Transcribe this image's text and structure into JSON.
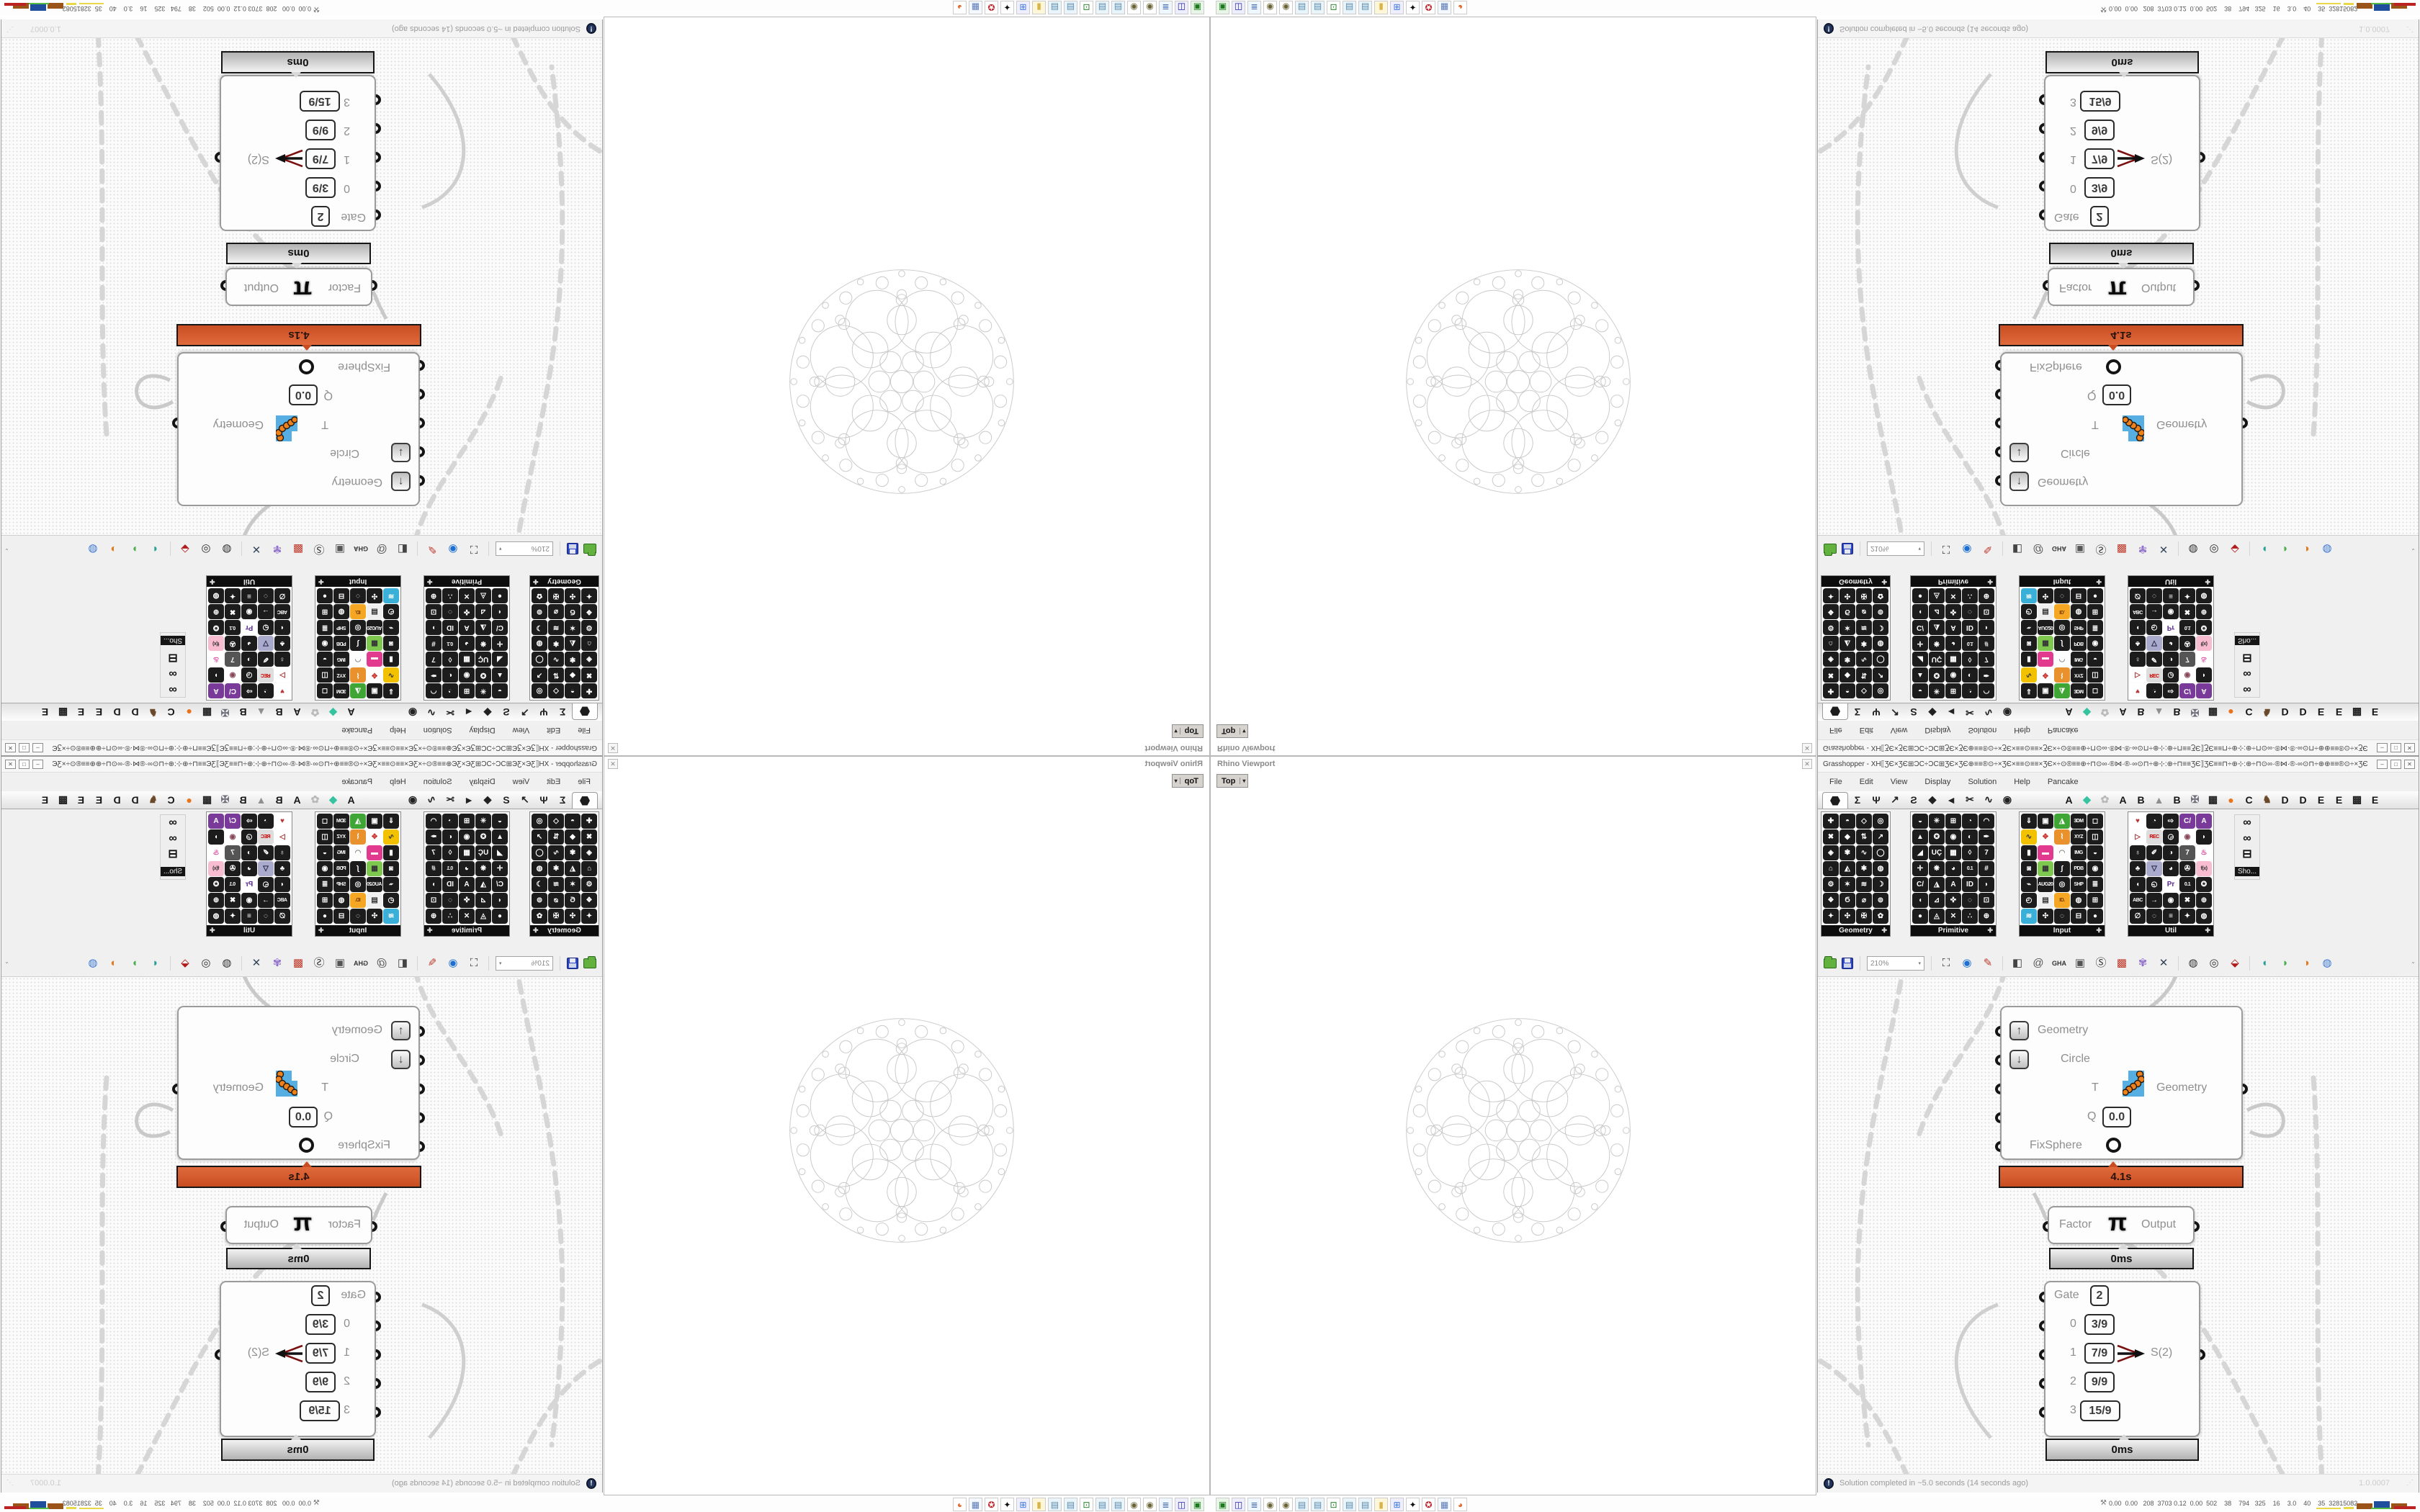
{
  "window": {
    "title": "Grasshopper - XH⟦ƷЄ×ƷЄ⊞ƆϹ÷ƆϹ⊞ƷЄ×ƷЄ⊕≡≡®⊙÷×ƷЄ×≡≡⊙≡≡×ƷЄ×÷⊙®≡≡⊕÷⊓⊙∞·®⋈·®·∞⊙⊓÷⊕⊹:⊕÷⊓≡≡ƷЄ⟧ƷЄ≡≡⊓÷⊕⊹:⊕÷⊓⊙∞·®⋈·®·∞⊙⊓÷⊕⊕≡≡®⊙÷×ƷЄ×≡≡⊙≡≡⊙...",
    "btn_min": "–",
    "btn_max": "□",
    "btn_close": "✕"
  },
  "menu": {
    "items": [
      "File",
      "Edit",
      "View",
      "Display",
      "Solution",
      "Help",
      "Pancake"
    ]
  },
  "tabs": {
    "tool_glyphs": [
      "Σ",
      "Ψ",
      "↗",
      "Ƨ",
      "◆",
      "◄",
      "✂",
      "∿",
      "◉"
    ],
    "letter_tabs": [
      {
        "g": "A",
        "c": "#151515"
      },
      {
        "g": "◆",
        "c": "#35c4a0"
      },
      {
        "g": "✿",
        "c": "#b9b9b9"
      },
      {
        "g": "A",
        "c": "#151515"
      },
      {
        "g": "B",
        "c": "#151515"
      },
      {
        "g": "▲",
        "c": "#8f8f8f"
      },
      {
        "g": "B",
        "c": "#151515"
      },
      {
        "g": "✠",
        "c": "#6d6d78"
      },
      {
        "g": "▦",
        "c": "#222222"
      },
      {
        "g": "●",
        "c": "#e8731a"
      },
      {
        "g": "C",
        "c": "#151515"
      },
      {
        "g": "♞",
        "c": "#6b4a2b"
      },
      {
        "g": "D",
        "c": "#151515"
      },
      {
        "g": "D",
        "c": "#151515"
      },
      {
        "g": "E",
        "c": "#151515"
      },
      {
        "g": "E",
        "c": "#151515"
      },
      {
        "g": "▩",
        "c": "#222222"
      },
      {
        "g": "E",
        "c": "#151515"
      }
    ]
  },
  "palettes": {
    "panels": [
      {
        "name": "Geometry",
        "cols": 4,
        "icons": [
          "✚",
          "◓",
          "◇",
          "◎",
          "✖",
          "◆",
          "⇅",
          "↗",
          "◈",
          "✾",
          "∿",
          "◯",
          "⌂",
          "◭",
          "✱",
          "◍",
          "⚙",
          "✶",
          "≋",
          "☽",
          "❖",
          "Ϭ",
          "⌀",
          "⊚",
          "✦",
          "✣",
          "✠",
          "✿"
        ]
      },
      {
        "name": "Primitive",
        "cols": 5,
        "icons": [
          "◒",
          "✳",
          "⊞",
          "◔",
          "◠",
          "▲",
          "✪",
          "◉",
          "◐",
          "✒",
          "◢",
          "UÇ",
          "▦",
          "◊",
          "7",
          "✛",
          "❋",
          "◕",
          "0.1",
          "#",
          "C/",
          "◮",
          "A",
          "ID",
          "◗",
          "◖",
          "⊿",
          "✜",
          "◌",
          "⊡",
          "●",
          "◬",
          "✕",
          "∴",
          "⊕"
        ]
      },
      {
        "name": "Input",
        "cols": 5,
        "icons": [
          "⇓",
          "▣",
          "◮|#3fa535",
          "3DM",
          "◻",
          "∿|#f2c200|#333",
          "✥|#fefefe|#c33",
          "⌇|#e8912d",
          "XYZ",
          "◫",
          "▮",
          "▬|#e23a8e",
          "◠|#fdfdfd|#888",
          "IMG",
          "◒",
          "◙",
          "▦|#7ec850|#333",
          "∫",
          "PDB",
          "◉",
          "⌁",
          "AUG20",
          "◎",
          "SHP",
          "≣",
          "◴",
          "▤|#f0f0f0|#333",
          "ID.|#f5a623|#7a3a00",
          "◍",
          "⊞",
          "≋|#3ab0d8",
          "✣",
          "◌",
          "⊟",
          "●"
        ]
      },
      {
        "name": "Util",
        "cols": 5,
        "icons": [
          "♥|#ffffff|#b43a3a",
          "◔",
          "⇨",
          "C/|#7a3a9a",
          "A|#7a3a9a",
          "▷|#ffffff|#a33333",
          "REC|#dddddd|#cc0000",
          "◶",
          "◉|#ffffff|#884455",
          "◗",
          "♁",
          "✐",
          "◑",
          "7|#555555",
          "♨|#ffffff|#d3429a",
          "♣",
          "▽|#aaaacc|#222244",
          "◕",
          "✇",
          "f(x)|#f8bcd0|#333333",
          "◖",
          "◵",
          "Pr|#ffffff|#5a2d91",
          "0.1",
          "✪",
          "ABC",
          "→",
          "◉",
          "✖",
          "⊕",
          "∅",
          "◌",
          "≡",
          "✦",
          "◍"
        ]
      }
    ],
    "floating": {
      "icons": [
        "∞",
        "∞",
        "⊟"
      ],
      "tooltip": "Sho..."
    }
  },
  "toolbar": {
    "zoom_value": "210%",
    "icons": [
      {
        "name": "zoom-extents-icon",
        "g": "⛶",
        "c": "#333333"
      },
      {
        "name": "preview-eye-icon",
        "g": "◉",
        "c": "#1d6fd1"
      },
      {
        "name": "wire-pen-icon",
        "g": "✎",
        "c": "#c0392b"
      },
      {
        "name": "bake-icon",
        "g": "◧",
        "c": "#444444"
      },
      {
        "name": "at-icon",
        "g": "@",
        "c": "#555555"
      },
      {
        "name": "gha-icon",
        "g": "GHA",
        "c": "#333333"
      },
      {
        "name": "capture-icon",
        "g": "▣",
        "c": "#555555"
      },
      {
        "name": "find-icon",
        "g": "Ⓢ",
        "c": "#333333"
      },
      {
        "name": "surprise-box-icon",
        "g": "▩",
        "c": "#c0392b"
      },
      {
        "name": "hint-balloon-icon",
        "g": "✾",
        "c": "#8e6fc9"
      },
      {
        "name": "dna-icon",
        "g": "✕",
        "c": "#33445a"
      },
      {
        "name": "shaded-preview-icon",
        "g": "◍",
        "c": "#333333"
      },
      {
        "name": "wire-preview-icon",
        "g": "◎",
        "c": "#333333"
      },
      {
        "name": "gem-preview-icon",
        "g": "⬙",
        "c": "#b01b1b"
      },
      {
        "name": "blob-teal-icon",
        "g": "◖",
        "c": "#2aa198"
      },
      {
        "name": "blob-green-icon",
        "g": "◗",
        "c": "#4caf50"
      },
      {
        "name": "blob-orange-icon",
        "g": "◑",
        "c": "#e07b20"
      },
      {
        "name": "blob-blue-icon",
        "g": "◍",
        "c": "#3a76d6"
      }
    ]
  },
  "canvas": {
    "node_transform": {
      "in_geometry": "Geometry",
      "in_circle": "Circle",
      "in_t": "T",
      "in_q": "Q",
      "q_value": "0.0",
      "in_fixsphere": "FixSphere",
      "output": "Geometry",
      "profiler": "4.1s",
      "up_glyph": "↑",
      "down_glyph": "↓"
    },
    "node_pi": {
      "left": "Factor",
      "glyph": "π",
      "right": "Output",
      "profiler": "0ms"
    },
    "node_gate": {
      "rows": [
        {
          "label": "Gate",
          "value": "2"
        },
        {
          "label": "0",
          "value": "3/9"
        },
        {
          "label": "1",
          "value": "7/9"
        },
        {
          "label": "2",
          "value": "9/9"
        },
        {
          "label": "3",
          "value": "15/9"
        }
      ],
      "output": "S(2)",
      "profiler": "0ms"
    }
  },
  "statusbar": {
    "solver_glyph": "!",
    "text": "Solution completed in ~5.0 seconds (14 seconds ago)",
    "version": "1.0.0007",
    "grip": "⋰"
  },
  "rhino": {
    "title": "Rhino Viewport",
    "viewport_label": "Top",
    "dropdown_glyph": "▾",
    "close_glyph": "✕"
  },
  "taskbar": {
    "person_glyph": "⚒",
    "stats": "0.00  0.00   208  3703 0.12  0.00  502    38    794   325    16    3.0    40    35  32815082",
    "icons": [
      {
        "name": "emulator-icon",
        "g": "▣",
        "bg": "#e8f6e8",
        "c": "#1d7a1d"
      },
      {
        "name": "floppy64-icon",
        "g": "◫",
        "bg": "#eeeeff",
        "c": "#23239b"
      },
      {
        "name": "script-icon",
        "g": "≣",
        "bg": "#eef6ff",
        "c": "#4a6fb5"
      },
      {
        "name": "coin-icon",
        "g": "◉",
        "bg": "#ffffff",
        "c": "#6b6436"
      },
      {
        "name": "coin2-icon",
        "g": "◉",
        "bg": "#ffffff",
        "c": "#6b6436"
      },
      {
        "name": "notepad-icon",
        "g": "▤",
        "bg": "#eaf4fb",
        "c": "#5588aa"
      },
      {
        "name": "notepad2-icon",
        "g": "▤",
        "bg": "#eaf4fb",
        "c": "#5588aa"
      },
      {
        "name": "monitor-icon",
        "g": "⊡",
        "bg": "#ffffff",
        "c": "#1d7a1d"
      },
      {
        "name": "notepad3-icon",
        "g": "▤",
        "bg": "#eaf4fb",
        "c": "#5588aa"
      },
      {
        "name": "notepad4-icon",
        "g": "▤",
        "bg": "#eaf4fb",
        "c": "#5588aa"
      },
      {
        "name": "folder-icon",
        "g": "▮",
        "bg": "#fdf6d8",
        "c": "#d8b44a"
      },
      {
        "name": "control-panel-icon",
        "g": "⊞",
        "bg": "#eeeeff",
        "c": "#3a76d6"
      },
      {
        "name": "art-icon",
        "g": "✦",
        "bg": "#ffffff",
        "c": "#111111"
      },
      {
        "name": "emblem-icon",
        "g": "✪",
        "bg": "#ffffff",
        "c": "#c0272d"
      },
      {
        "name": "calculator-icon",
        "g": "▦",
        "bg": "#f4f8ff",
        "c": "#5a7ab5"
      },
      {
        "name": "browser-icon",
        "g": "◕",
        "bg": "#ffffff",
        "c": "#e0662a"
      }
    ]
  }
}
